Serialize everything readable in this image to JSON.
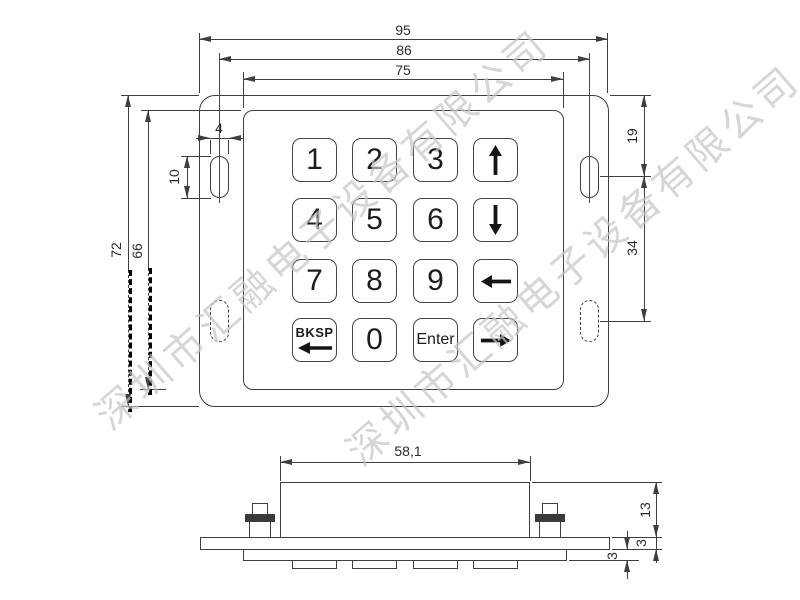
{
  "watermark": {
    "text": "深圳市汇融电子设备有限公司",
    "color": "#c6c6c6"
  },
  "colors": {
    "line": "#3f3f3f",
    "dim_text": "#2b2b2b",
    "background": "#ffffff",
    "key_label": "#1c1c1c"
  },
  "top_view": {
    "description": "keypad front view with mounting plate, bezel and 4x4 key matrix",
    "dims": {
      "overall_width": "95",
      "hole_pitch": "86",
      "bezel_width": "75",
      "overall_height": "72",
      "bezel_height": "66",
      "slot_width": "4",
      "slot_length": "10",
      "slot_top_offset": "19",
      "slot_vertical_pitch": "34"
    },
    "keys": [
      {
        "label": "1",
        "type": "digit"
      },
      {
        "label": "2",
        "type": "digit"
      },
      {
        "label": "3",
        "type": "digit"
      },
      {
        "label": "up-arrow",
        "type": "icon"
      },
      {
        "label": "4",
        "type": "digit"
      },
      {
        "label": "5",
        "type": "digit"
      },
      {
        "label": "6",
        "type": "digit"
      },
      {
        "label": "down-arrow",
        "type": "icon"
      },
      {
        "label": "7",
        "type": "digit"
      },
      {
        "label": "8",
        "type": "digit"
      },
      {
        "label": "9",
        "type": "digit"
      },
      {
        "label": "left-arrow",
        "type": "icon"
      },
      {
        "label": "BKSP",
        "type": "text-icon"
      },
      {
        "label": "0",
        "type": "digit"
      },
      {
        "label": "Enter",
        "type": "text"
      },
      {
        "label": "right-arrow",
        "type": "icon"
      }
    ]
  },
  "side_view": {
    "description": "keypad side profile with housing, plate, pad and key bosses",
    "dims": {
      "housing_width": "58,1",
      "housing_height": "13",
      "plate_thickness": "3",
      "pad_thickness": "3"
    }
  }
}
